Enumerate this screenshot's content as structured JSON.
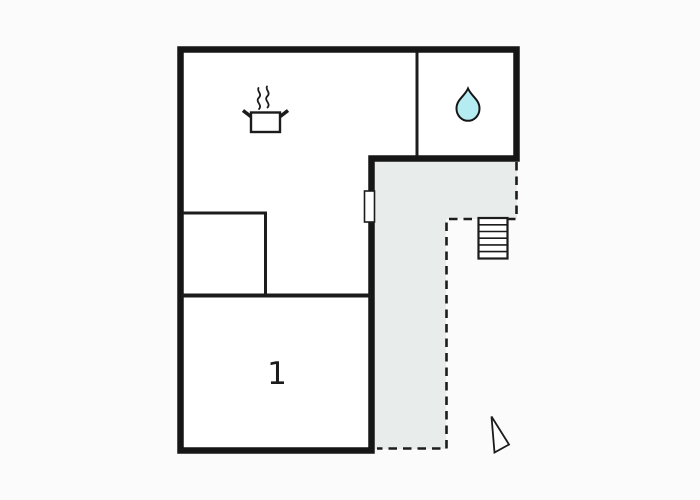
{
  "plan": {
    "type": "floor-plan",
    "room_label": "1",
    "icons": {
      "kitchen": "cooking-pot-icon",
      "bathroom": "water-drop-icon",
      "stairs": "stairs-icon",
      "door": "door-symbol",
      "compass": "north-arrow-icon"
    },
    "colors": {
      "background": "#fbfbfb",
      "room_fill": "#ffffff",
      "wall": "#161616",
      "line": "#1c1c1c",
      "terrace_fill": "#e8edeb",
      "drop_fill": "#b5ecf2",
      "label": "#1b1b1b"
    }
  }
}
